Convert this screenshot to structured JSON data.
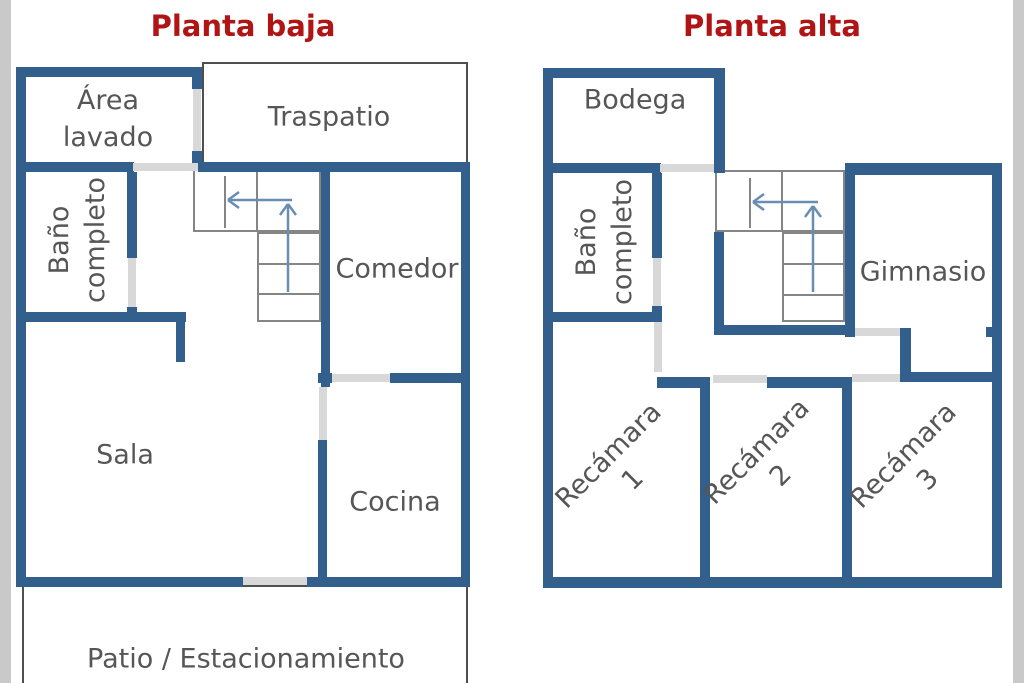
{
  "colors": {
    "wall": "#335f8c",
    "door": "#d8d8d8",
    "outline": "#4f4f4f",
    "stairline": "#858585",
    "arrow": "#6a8db4",
    "title": "#b01414",
    "label": "#565656",
    "edge": "#c9c9c9"
  },
  "plans": [
    {
      "title": "Planta baja",
      "rooms": {
        "area_lavado": {
          "line1": "Área",
          "line2": "lavado"
        },
        "traspatio": {
          "label": "Traspatio"
        },
        "bano": {
          "line1": "Baño",
          "line2": "completo"
        },
        "comedor": {
          "label": "Comedor"
        },
        "sala": {
          "label": "Sala"
        },
        "cocina": {
          "label": "Cocina"
        },
        "patio": {
          "label": "Patio / Estacionamiento"
        }
      }
    },
    {
      "title": "Planta alta",
      "rooms": {
        "bodega": {
          "label": "Bodega"
        },
        "bano": {
          "line1": "Baño",
          "line2": "completo"
        },
        "gimnasio": {
          "label": "Gimnasio"
        },
        "recamara1": {
          "line1": "Recámara",
          "line2": "1"
        },
        "recamara2": {
          "line1": "Recámara",
          "line2": "2"
        },
        "recamara3": {
          "line1": "Recámara",
          "line2": "3"
        }
      }
    }
  ]
}
